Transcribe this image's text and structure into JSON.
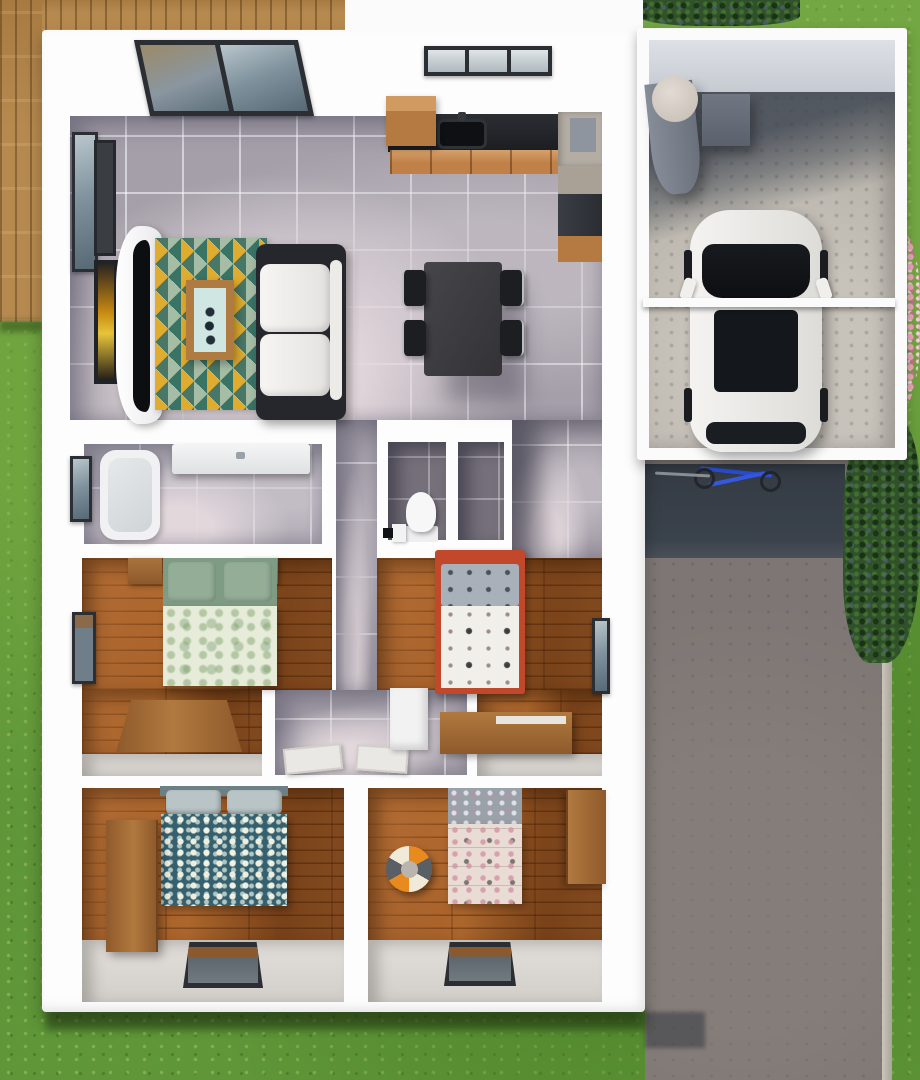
{
  "meta": {
    "description": "Top-down 3D architectural render of a single-storey house floor plan with attached garage, driveway, timber deck and lawn",
    "view": "top-down 3d floor plan",
    "visible_text": []
  },
  "palette": {
    "wall_white": "#fdfdfd",
    "lawn_green": "#5f9638",
    "deck_wood": "#b68a4f",
    "floor_tile_grey": "#a59fa9",
    "floor_tile_dark": "#75707a",
    "floor_timber": "#9c5526",
    "driveway_grey": "#7d7674",
    "garage_concrete": "#b8b3ab",
    "garage_shadow": "#384049",
    "shrub_green": "#31512b",
    "flower_pink": "#e9a8b8",
    "rug_colors": [
      "#2f6d5f",
      "#dfa826",
      "#ece5d2",
      "#9fb9a0"
    ],
    "bed1_bedding": [
      "#7e9b84",
      "#e6ecd9"
    ],
    "bed2_frame_red": "#c2482c",
    "bed2_duvet": "#f1efe9",
    "bed3_duvet_teal": "#35606f",
    "bed4_quilt": "#e8dcd4",
    "ball_colors": [
      "#e98a1f",
      "#5a5f66",
      "#f2ead8"
    ],
    "car_body": "#f4f3f1",
    "car_glass": "#14171b",
    "counter_black": "#1b1d21",
    "cabinet_timber": "#c08048",
    "bicycle_blue": "#2a4fd6"
  },
  "outdoor": {
    "areas": [
      {
        "name": "lawn",
        "color": "#5f9638"
      },
      {
        "name": "timber-deck",
        "position": "top-left corner",
        "color": "#b68a4f"
      },
      {
        "name": "driveway",
        "position": "right side below garage",
        "color": "#7d7674"
      },
      {
        "name": "garage-door-shadow",
        "color": "#384049"
      },
      {
        "name": "shrubs",
        "positions": [
          "top edge right of house",
          "right of driveway"
        ],
        "color": "#31512b"
      },
      {
        "name": "pink-flower-bed",
        "position": "right edge beside garage",
        "color": "#e9a8b8"
      },
      {
        "name": "bicycle",
        "position": "lying in driveway shadow",
        "color": "#2a4fd6"
      }
    ]
  },
  "house": {
    "wall_color": "#fdfdfd",
    "rooms": [
      {
        "name": "living-room",
        "floor": "grey ceramic tile",
        "furniture": [
          "glass roof skylight panels",
          "side window",
          "two wall art frames (one amber)",
          "curved black wall tv",
          "white curved tv console",
          "triangle pattern area rug",
          "timber coffee table with mint glass top",
          "sofa with charcoal frame and white cushions"
        ]
      },
      {
        "name": "kitchen-dining",
        "floor": "grey ceramic tile",
        "furniture": [
          "L-shaped black countertop with timber cabinet fronts",
          "black sink with faucet",
          "window above counter",
          "timber wall cabinet",
          "fridge",
          "dark cooker unit",
          "dark dining table",
          "four black dining chairs"
        ]
      },
      {
        "name": "bathroom",
        "floor": "grey tile",
        "furniture": [
          "white bathtub",
          "white vanity counter",
          "side window"
        ]
      },
      {
        "name": "wc",
        "floor": "dark grey tile",
        "compartments": 2,
        "furniture": [
          "white toilet",
          "small white cabinet",
          "black floor mat"
        ]
      },
      {
        "name": "hallway",
        "floor": "grey tile",
        "furniture": [
          "two open white doors at bedroom thresholds"
        ]
      },
      {
        "name": "bedroom-1",
        "floor": "timber planks",
        "furniture": [
          "double bed with green botanical bedding",
          "two timber nightstands",
          "angled timber dresser",
          "side window"
        ]
      },
      {
        "name": "bedroom-2",
        "floor": "timber planks",
        "furniture": [
          "double bed with red frame, grey patterned pillows and white motif duvet",
          "timber dresser",
          "white corner desk",
          "side window"
        ]
      },
      {
        "name": "bedroom-3",
        "floor": "timber planks",
        "furniture": [
          "bed with teal floral duvet and grey pillows",
          "timber wardrobe",
          "window in bottom wall"
        ]
      },
      {
        "name": "bedroom-4",
        "floor": "timber planks",
        "furniture": [
          "single bed with pink-beige patchwork quilt",
          "orange-grey-cream beach ball",
          "timber desk unit",
          "window in bottom wall"
        ]
      }
    ]
  },
  "garage": {
    "floor": "concrete",
    "contents": [
      "grey cylindrical water tank with light lid",
      "grey utility box",
      "white car parked facing down with black windshield, sunroof and rear glass",
      "garage door header beam crossing over car"
    ]
  }
}
